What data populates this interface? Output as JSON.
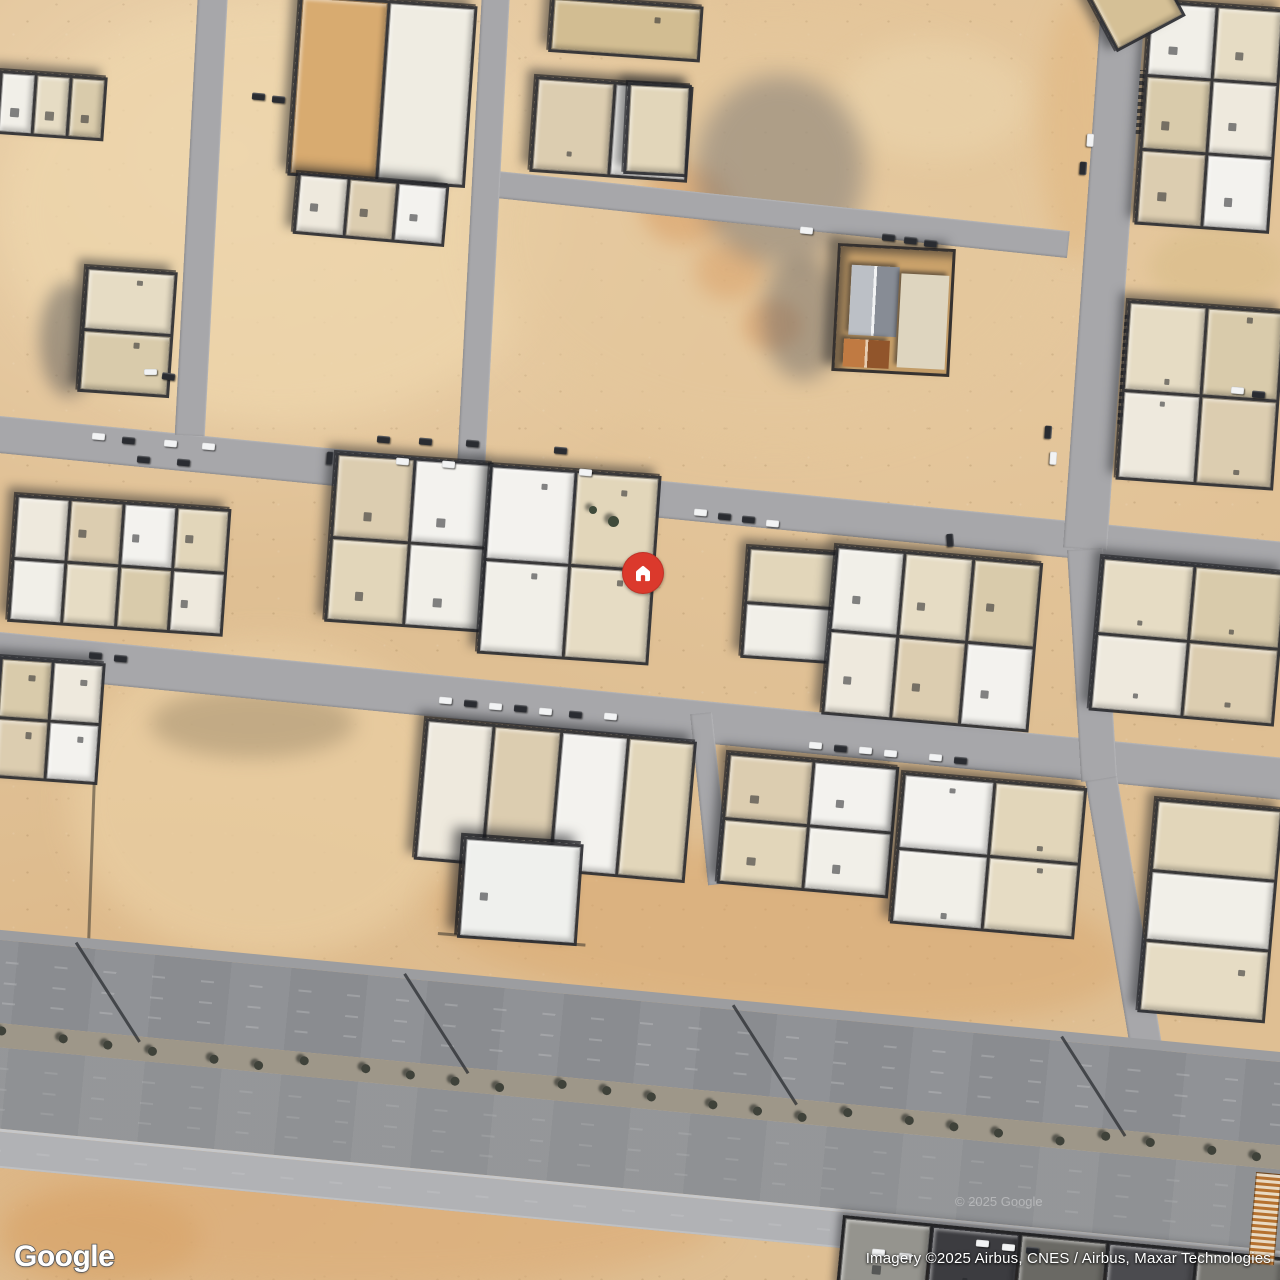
{
  "ui": {
    "logo": {
      "text": "Google"
    },
    "attribution": {
      "text": "Imagery ©2025 Airbus, CNES / Airbus, Maxar Technologies"
    },
    "watermark": {
      "text": "© 2025 Google"
    }
  },
  "marker": {
    "icon": "home-icon",
    "color": "#db392c",
    "x": 643,
    "y": 573,
    "diameter": 42
  },
  "palette": {
    "sand": "#dfbf93",
    "road": "#a7a7aa",
    "highway_shoulder": "#9c9da0",
    "highway_upper": "#8a8c90",
    "highway_median": "#9e9789",
    "highway_lower": "#8f9194",
    "highway_divider": "#c6c7c9",
    "highway_service": "#b1b2b5",
    "block_gap": "#2c2d30",
    "roof_white": "#f1efe8",
    "roof_tan": "#d9cbab",
    "marker_red": "#db392c",
    "unit_colors_light": [
      "#f1efe8",
      "#e6dcc4",
      "#d9cbab",
      "#eee9dd",
      "#dccdb0",
      "#f3f2ee",
      "#e2d6ba"
    ],
    "unit_colors_dark": [
      "#4b4b4f",
      "#777671",
      "#95948e",
      "#3c3c40",
      "#6a6964"
    ]
  },
  "features": {
    "patches": [
      {
        "x": 0,
        "y": 0,
        "w": 560,
        "h": 425,
        "color": "#eed6ac",
        "op": 0.75,
        "blur": 18
      },
      {
        "x": 480,
        "y": 25,
        "w": 590,
        "h": 415,
        "color": "#e4c79c",
        "op": 0.65,
        "blur": 20
      },
      {
        "x": 640,
        "y": 165,
        "w": 90,
        "h": 80,
        "color": "#d89a60",
        "op": 0.5,
        "blur": 10
      },
      {
        "x": 695,
        "y": 240,
        "w": 70,
        "h": 60,
        "color": "#d89a60",
        "op": 0.45,
        "blur": 10
      },
      {
        "x": 742,
        "y": 300,
        "w": 60,
        "h": 50,
        "color": "#d49058",
        "op": 0.4,
        "blur": 8
      },
      {
        "x": 840,
        "y": 40,
        "w": 190,
        "h": 120,
        "color": "#ecd7b0",
        "op": 0.5,
        "blur": 14
      },
      {
        "x": 70,
        "y": 640,
        "w": 390,
        "h": 320,
        "color": "#e9cda1",
        "op": 0.8,
        "blur": 16,
        "grit": true
      },
      {
        "x": 430,
        "y": 850,
        "w": 700,
        "h": 170,
        "color": "#d9a76e",
        "op": 0.5,
        "blur": 14,
        "ang": 5,
        "grit": true
      },
      {
        "x": 0,
        "y": 1150,
        "w": 720,
        "h": 140,
        "color": "#dcae7a",
        "op": 0.7,
        "blur": 16
      },
      {
        "x": 0,
        "y": 1190,
        "w": 200,
        "h": 95,
        "color": "#d8a469",
        "op": 0.6,
        "blur": 12
      },
      {
        "x": 1040,
        "y": 0,
        "w": 70,
        "h": 260,
        "color": "#e0b67f",
        "op": 0.55,
        "blur": 12
      },
      {
        "x": 1150,
        "y": 228,
        "w": 135,
        "h": 78,
        "color": "#dcc08f",
        "op": 0.85,
        "blur": 8
      },
      {
        "x": 695,
        "y": 75,
        "w": 170,
        "h": 190,
        "color": "#64666c",
        "op": 0.42,
        "blur": 12,
        "name": "building-shadow"
      },
      {
        "x": 150,
        "y": 688,
        "w": 205,
        "h": 70,
        "color": "#8d7c60",
        "op": 0.4,
        "blur": 10,
        "name": "mound-shadow"
      },
      {
        "x": 40,
        "y": 282,
        "w": 58,
        "h": 115,
        "color": "#4d4e52",
        "op": 0.45,
        "blur": 8,
        "name": "building-shadow"
      },
      {
        "x": 762,
        "y": 255,
        "w": 82,
        "h": 125,
        "color": "#55565c",
        "op": 0.4,
        "blur": 10,
        "name": "building-shadow"
      }
    ],
    "walls": [
      {
        "x": 100,
        "y": 660,
        "len": 300,
        "ang": 92
      },
      {
        "x": 100,
        "y": 660,
        "len": 345,
        "ang": 5
      },
      {
        "x": 438,
        "y": 932,
        "len": 148,
        "ang": 4.5
      }
    ],
    "roads": [
      {
        "x": -20,
        "y": 414,
        "len": 1340,
        "w": 37,
        "ang": 5.6
      },
      {
        "x": -20,
        "y": 630,
        "len": 1340,
        "w": 42,
        "ang": 5.6
      },
      {
        "x": 488,
        "y": 170,
        "len": 585,
        "w": 27,
        "ang": 6.0
      },
      {
        "x": 228,
        "y": -8,
        "len": 445,
        "w": 30,
        "ang": 93.0
      },
      {
        "x": 510,
        "y": -8,
        "len": 490,
        "w": 28,
        "ang": 93.0
      },
      {
        "x": 1146,
        "y": -8,
        "len": 560,
        "w": 44,
        "ang": 94.0
      },
      {
        "x": 1103,
        "y": 548,
        "len": 232,
        "w": 36,
        "ang": 86.5
      },
      {
        "x": 1117,
        "y": 776,
        "len": 292,
        "w": 32,
        "ang": 80.5
      },
      {
        "x": 712,
        "y": 712,
        "len": 172,
        "w": 22,
        "ang": 84.0
      }
    ],
    "street_labels": [
      {
        "x": 1140,
        "y": 70,
        "len": 64,
        "ang": 4
      },
      {
        "x": 1125,
        "y": 312,
        "len": 112,
        "ang": 4
      }
    ],
    "highway": {
      "x": -40,
      "y": 926,
      "len": 1400,
      "ang": 5.45,
      "bands": [
        {
          "h": 10,
          "color": "#9c9da0",
          "kind": "shoulder"
        },
        {
          "h": 83,
          "color": "#8a8c90",
          "kind": "carriageway"
        },
        {
          "h": 24,
          "color": "#9e9789",
          "kind": "median"
        },
        {
          "h": 81,
          "color": "#8f9194",
          "kind": "carriageway"
        },
        {
          "h": 3,
          "color": "#c6c7c9",
          "kind": "divider"
        },
        {
          "h": 36,
          "color": "#b1b2b5",
          "kind": "service"
        }
      ],
      "tree_count": 26,
      "pole_shadows": [
        190,
        520,
        850,
        1180
      ]
    },
    "blocks": [
      {
        "x": 0,
        "y": 70,
        "w": 108,
        "h": 64,
        "ang": 4,
        "cols": 3,
        "rows": 1
      },
      {
        "x": 86,
        "y": 266,
        "w": 92,
        "h": 126,
        "ang": 4,
        "cols": 1,
        "rows": 2
      },
      {
        "x": 300,
        "y": -6,
        "w": 178,
        "h": 182,
        "ang": 4,
        "cols": 2,
        "rows": 1,
        "colors": [
          "#d8ab70",
          "#efece2"
        ]
      },
      {
        "x": 298,
        "y": 172,
        "w": 152,
        "h": 62,
        "ang": 5,
        "cols": 3,
        "rows": 1
      },
      {
        "x": 536,
        "y": 76,
        "w": 158,
        "h": 96,
        "ang": 4,
        "cols": 2,
        "rows": 1
      },
      {
        "x": 552,
        "y": -4,
        "w": 152,
        "h": 56,
        "ang": 4,
        "cols": 1,
        "rows": 1,
        "colors": [
          "#d2bd92"
        ]
      },
      {
        "x": 628,
        "y": 82,
        "w": 64,
        "h": 92,
        "ang": 3,
        "cols": 1,
        "rows": 1
      },
      {
        "x": 1150,
        "y": 0,
        "w": 135,
        "h": 225,
        "ang": 4,
        "cols": 2,
        "rows": 3
      },
      {
        "x": 1128,
        "y": 300,
        "w": 158,
        "h": 180,
        "ang": 4,
        "cols": 2,
        "rows": 2
      },
      {
        "x": 1086,
        "y": -6,
        "w": 78,
        "h": 66,
        "ang": -28,
        "cols": 1,
        "rows": 1,
        "colors": [
          "#d5c096"
        ]
      },
      {
        "x": 16,
        "y": 494,
        "w": 216,
        "h": 128,
        "ang": 4,
        "cols": 4,
        "rows": 2
      },
      {
        "x": 336,
        "y": 452,
        "w": 158,
        "h": 170,
        "ang": 4,
        "cols": 2,
        "rows": 2
      },
      {
        "x": 490,
        "y": 464,
        "w": 172,
        "h": 190,
        "ang": 4,
        "cols": 2,
        "rows": 2
      },
      {
        "x": 748,
        "y": 546,
        "w": 92,
        "h": 112,
        "ang": 4,
        "cols": 1,
        "rows": 2
      },
      {
        "x": 836,
        "y": 545,
        "w": 208,
        "h": 170,
        "ang": 5,
        "cols": 3,
        "rows": 2
      },
      {
        "x": 1102,
        "y": 556,
        "w": 186,
        "h": 155,
        "ang": 5,
        "cols": 2,
        "rows": 2
      },
      {
        "x": 0,
        "y": 656,
        "w": 106,
        "h": 122,
        "ang": 4,
        "cols": 2,
        "rows": 2
      },
      {
        "x": 426,
        "y": 718,
        "w": 272,
        "h": 142,
        "ang": 5,
        "cols": 4,
        "rows": 1
      },
      {
        "x": 728,
        "y": 752,
        "w": 172,
        "h": 132,
        "ang": 5,
        "cols": 2,
        "rows": 2
      },
      {
        "x": 903,
        "y": 772,
        "w": 185,
        "h": 152,
        "ang": 5,
        "cols": 2,
        "rows": 2
      },
      {
        "x": 1156,
        "y": 798,
        "w": 128,
        "h": 215,
        "ang": 5,
        "cols": 1,
        "rows": 3
      },
      {
        "x": 464,
        "y": 836,
        "w": 120,
        "h": 102,
        "ang": 4,
        "cols": 1,
        "rows": 1,
        "colors": [
          "#eff0ed"
        ],
        "strong": true
      },
      {
        "x": 843,
        "y": 1215,
        "w": 445,
        "h": 75,
        "ang": 5.5,
        "cols": 5,
        "rows": 1,
        "dark": true
      }
    ],
    "compound": {
      "x": 838,
      "y": 243,
      "w": 118,
      "h": 128,
      "ang": 3,
      "parts": [
        {
          "x": 12,
          "y": 18,
          "w": 48,
          "h": 70,
          "type": "gable-gray"
        },
        {
          "x": 8,
          "y": 92,
          "w": 46,
          "h": 28,
          "type": "gable-orange"
        },
        {
          "x": 62,
          "y": 24,
          "w": 48,
          "h": 94,
          "type": "flat"
        }
      ]
    },
    "fence": {
      "x": 1256,
      "y": 1172,
      "w": 26,
      "h": 92,
      "ang": 5
    },
    "trees": [
      {
        "x": 608,
        "y": 516,
        "d": 11
      },
      {
        "x": 589,
        "y": 506,
        "d": 8
      }
    ],
    "cars": [
      [
        98,
        436,
        5,
        0
      ],
      [
        128,
        440,
        5,
        1
      ],
      [
        143,
        459,
        5,
        1
      ],
      [
        170,
        443,
        5,
        0
      ],
      [
        183,
        462,
        5,
        1
      ],
      [
        208,
        446,
        5,
        0
      ],
      [
        330,
        458,
        95,
        1
      ],
      [
        383,
        439,
        5,
        1
      ],
      [
        402,
        461,
        5,
        0
      ],
      [
        425,
        441,
        5,
        1
      ],
      [
        448,
        464,
        5,
        0
      ],
      [
        472,
        443,
        5,
        1
      ],
      [
        560,
        450,
        5,
        1
      ],
      [
        585,
        472,
        5,
        0
      ],
      [
        700,
        512,
        5,
        0
      ],
      [
        724,
        516,
        5,
        1
      ],
      [
        748,
        519,
        5,
        1
      ],
      [
        772,
        523,
        5,
        0
      ],
      [
        950,
        540,
        85,
        1
      ],
      [
        95,
        655,
        5,
        1
      ],
      [
        120,
        658,
        5,
        1
      ],
      [
        445,
        700,
        5,
        0
      ],
      [
        470,
        703,
        5,
        1
      ],
      [
        495,
        706,
        5,
        0
      ],
      [
        520,
        708,
        5,
        1
      ],
      [
        545,
        711,
        5,
        0
      ],
      [
        575,
        714,
        5,
        1
      ],
      [
        610,
        716,
        5,
        0
      ],
      [
        815,
        745,
        5,
        0
      ],
      [
        840,
        748,
        5,
        1
      ],
      [
        865,
        750,
        5,
        0
      ],
      [
        890,
        753,
        5,
        0
      ],
      [
        935,
        757,
        5,
        0
      ],
      [
        960,
        760,
        5,
        1
      ],
      [
        1090,
        140,
        94,
        0
      ],
      [
        1083,
        168,
        94,
        1
      ],
      [
        1048,
        432,
        94,
        1
      ],
      [
        1053,
        458,
        94,
        0
      ],
      [
        1237,
        390,
        5,
        0
      ],
      [
        1258,
        394,
        5,
        1
      ],
      [
        150,
        372,
        0,
        0
      ],
      [
        168,
        376,
        8,
        1
      ],
      [
        888,
        237,
        6,
        1
      ],
      [
        910,
        240,
        6,
        1
      ],
      [
        930,
        243,
        6,
        1
      ],
      [
        806,
        230,
        6,
        0
      ],
      [
        258,
        96,
        5,
        1
      ],
      [
        278,
        99,
        5,
        1
      ],
      [
        905,
        1256,
        5,
        0
      ],
      [
        982,
        1243,
        5,
        0
      ],
      [
        1008,
        1247,
        5,
        0
      ],
      [
        1032,
        1250,
        5,
        1
      ],
      [
        878,
        1252,
        5,
        0
      ]
    ]
  }
}
